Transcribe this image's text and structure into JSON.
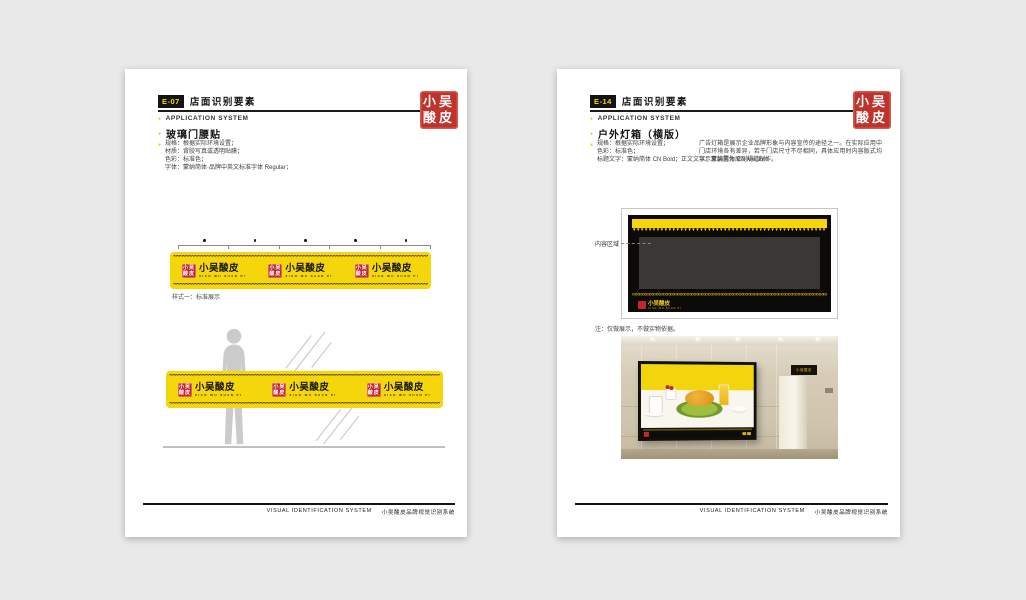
{
  "icons": {
    "bullet": "●"
  },
  "decor": {
    "wave": "~",
    "teeth": "▼",
    "chain": "∞"
  },
  "brand": {
    "name": "小吴酸皮",
    "name_en": "XIAO WU SUAN PI",
    "seal_top": "小吴",
    "seal_bottom": "酸皮"
  },
  "footer": {
    "en": "VISUAL IDENTIFICATION SYSTEM",
    "cn": "小吴酸皮品牌视觉识别系统"
  },
  "left_page": {
    "code": "E-07",
    "title": "店面识别要素",
    "section_en": "APPLICATION SYSTEM",
    "item_title": "玻璃门腰贴",
    "specs": [
      "规格：根据实际环境设置；",
      "材质：背胶写真或透明贴膜；",
      "色彩：标准色；",
      "字体：蒙纳简体·品牌中英文标准字体 Regular；"
    ],
    "caption": "样式一：标准展示"
  },
  "right_page": {
    "code": "E-14",
    "title": "店面识别要素",
    "section_en": "APPLICATION SYSTEM",
    "item_title": "户外灯箱（横版）",
    "specs": [
      "规格：根据实际环境设置；",
      "色彩：标准色；",
      "标题文字：蒙纳简体 CN Bold；正文文字：蒙纳简体 CN Medium"
    ],
    "description": "广告灯箱是展示企业品牌形象与内容宣传的途径之一。在实际应用中门店环境各有差异，若干门店尺寸不尽相同，具体应用时内容版式均以示意装置为原则规范制作。",
    "content_label": "内容区域",
    "note": "注：仅做展示，不做实物依据。"
  },
  "colors": {
    "accent_yellow": "#f5d60b",
    "seal_red": "#c1272d",
    "ink": "#141414",
    "background": "#e9e9e9"
  }
}
